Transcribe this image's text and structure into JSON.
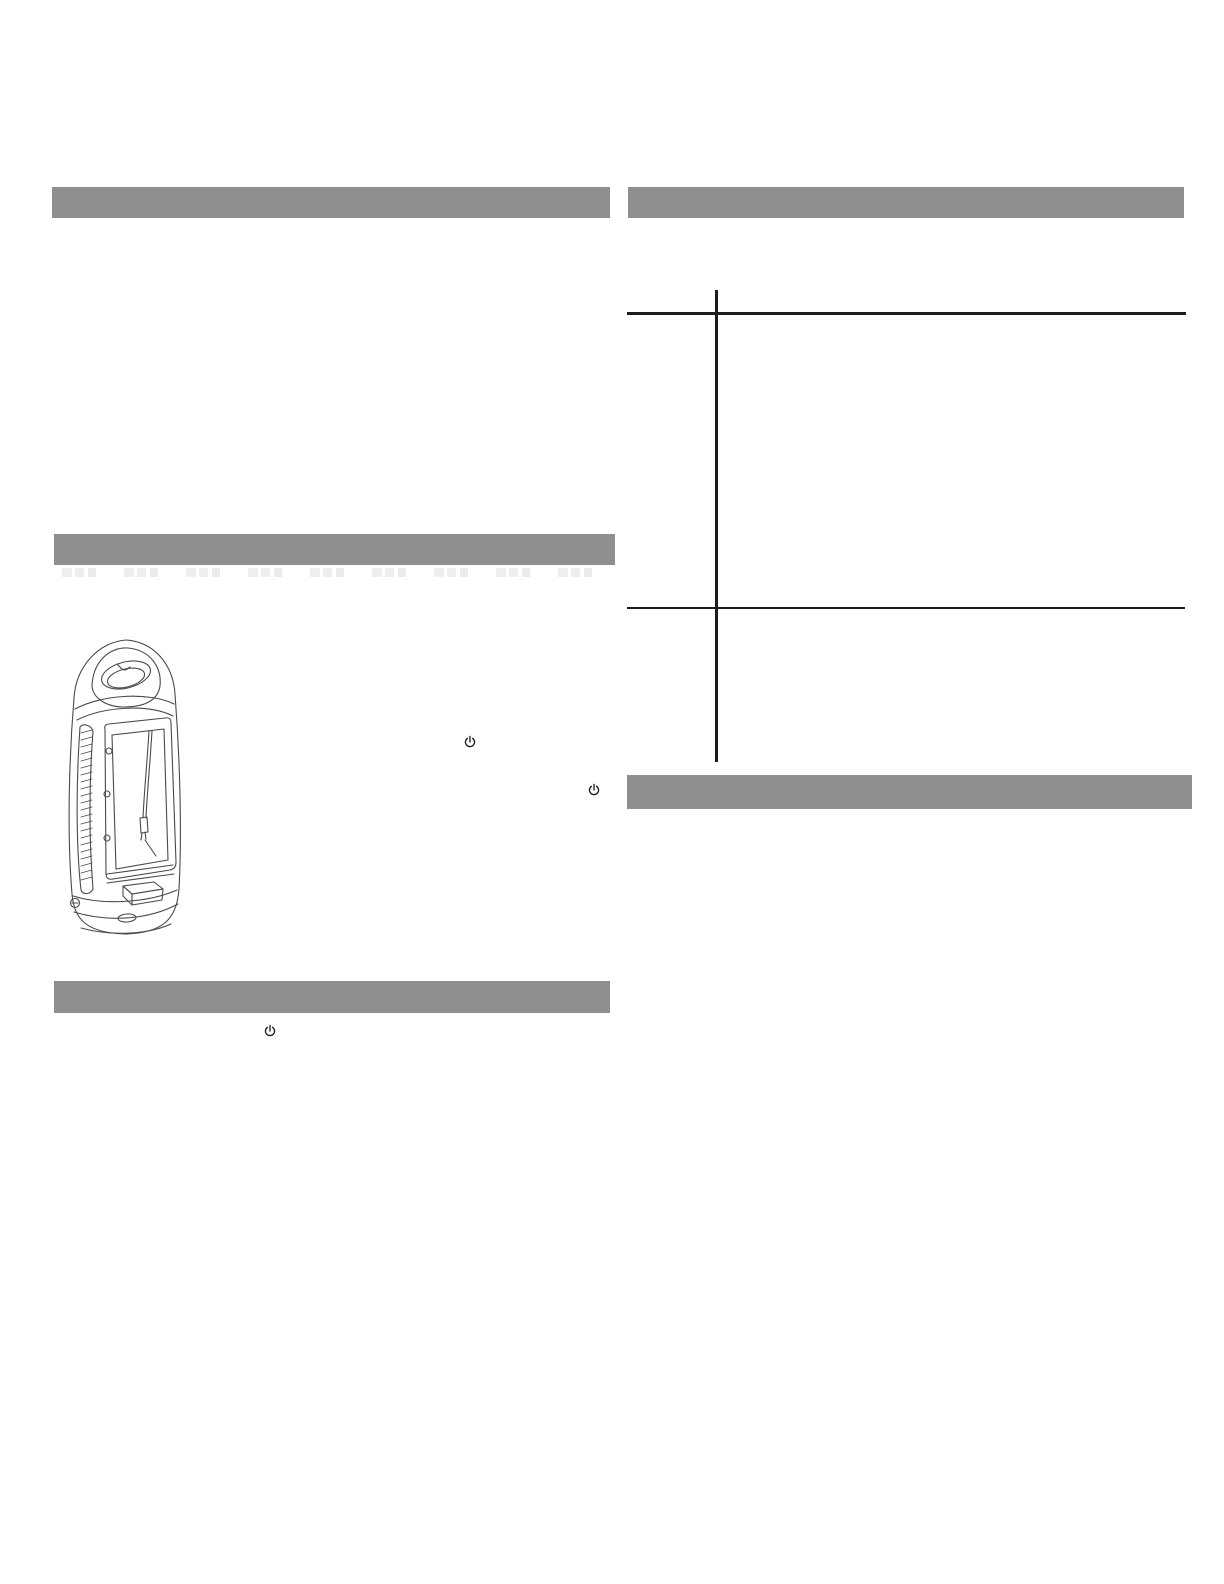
{
  "page": {
    "kind": "appliance-instruction-manual-page",
    "background": "#ffffff"
  },
  "colors": {
    "section_bar": "#8f8f8f",
    "table_rule": "#1c1c1c",
    "sketch_stroke": "#4a4a4a",
    "icon": "#1c1c1c",
    "ghost_text_artifact": "#ececec"
  },
  "left_column": {
    "section_bars": [
      {
        "label": ""
      },
      {
        "label": ""
      },
      {
        "label": ""
      }
    ],
    "figure": {
      "name": "lantern-device-line-drawing",
      "description": "Line drawing of a portable upright appliance with a carry handle on top, louvered side vents, a large front window with a hanging cord, and a pull-out tray at the base"
    },
    "power_symbols": [
      {
        "glyph": "power"
      },
      {
        "glyph": "power"
      },
      {
        "glyph": "power"
      }
    ]
  },
  "right_column": {
    "section_bars": [
      {
        "label": ""
      },
      {
        "label": ""
      }
    ],
    "table": {
      "type": "table",
      "columns": 2,
      "rows": 2,
      "cells": [
        [
          "",
          ""
        ],
        [
          "",
          ""
        ]
      ]
    }
  }
}
